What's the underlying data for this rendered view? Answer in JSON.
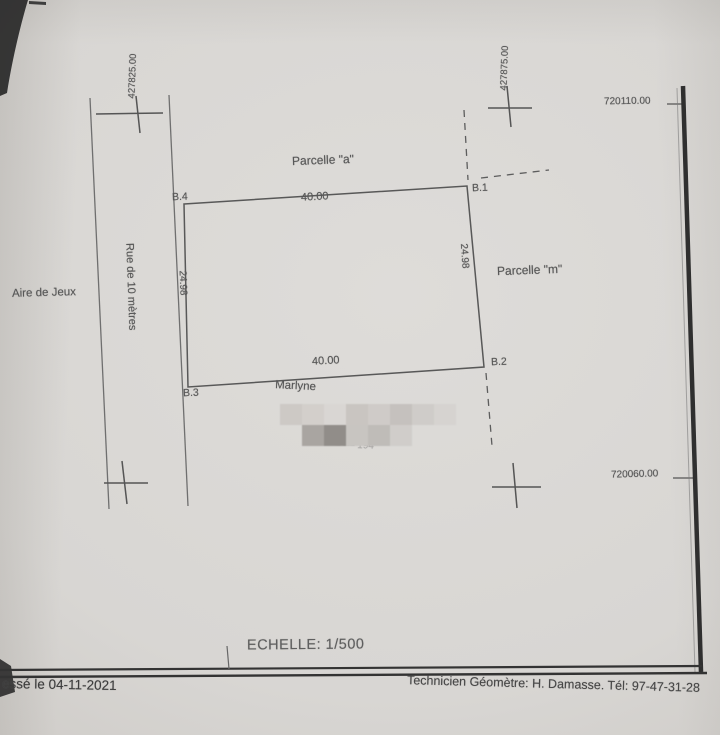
{
  "colors": {
    "ink": "#575757",
    "frame": "#333333",
    "paper": "#d7d5d2"
  },
  "plan": {
    "parcel_a_label": "Parcelle \"a\"",
    "parcel_m_label": "Parcelle \"m\"",
    "corner_b1": "B.1",
    "corner_b2": "B.2",
    "corner_b3": "B.3",
    "corner_b4": "B.4",
    "dim_top": "40.00",
    "dim_bottom": "40.00",
    "dim_left": "24.98",
    "dim_right": "24.98",
    "street_label": "Rue de 10 mètres",
    "playground_label": "Aire de Jeux",
    "owner_name_partial": "Marlyne",
    "owner_fragment": "– –– 194",
    "scale_label": "ECHELLE: 1/500",
    "coordinates": {
      "easting_left": "427825.00",
      "easting_right": "427875.00",
      "northing_top": "720110.00",
      "northing_bottom": "720060.00"
    }
  },
  "footer": {
    "date_line": "essé le 04-11-2021",
    "surveyor_line": "Technicien Géomètre: H. Damasse. Tél: 97-47-31-28"
  },
  "redaction": {
    "rows": [
      [
        "#cdc9c5",
        "#d3cfcb",
        "#d9d6d3",
        "#c9c5c1",
        "#cfcbc8",
        "#c5c1be",
        "#cfccc9",
        "#d6d3d0"
      ],
      [
        "transparent",
        "#a9a5a1",
        "#918d89",
        "#c8c5c1",
        "#bfbcb8",
        "#d0cdca",
        "transparent",
        "transparent"
      ]
    ]
  }
}
